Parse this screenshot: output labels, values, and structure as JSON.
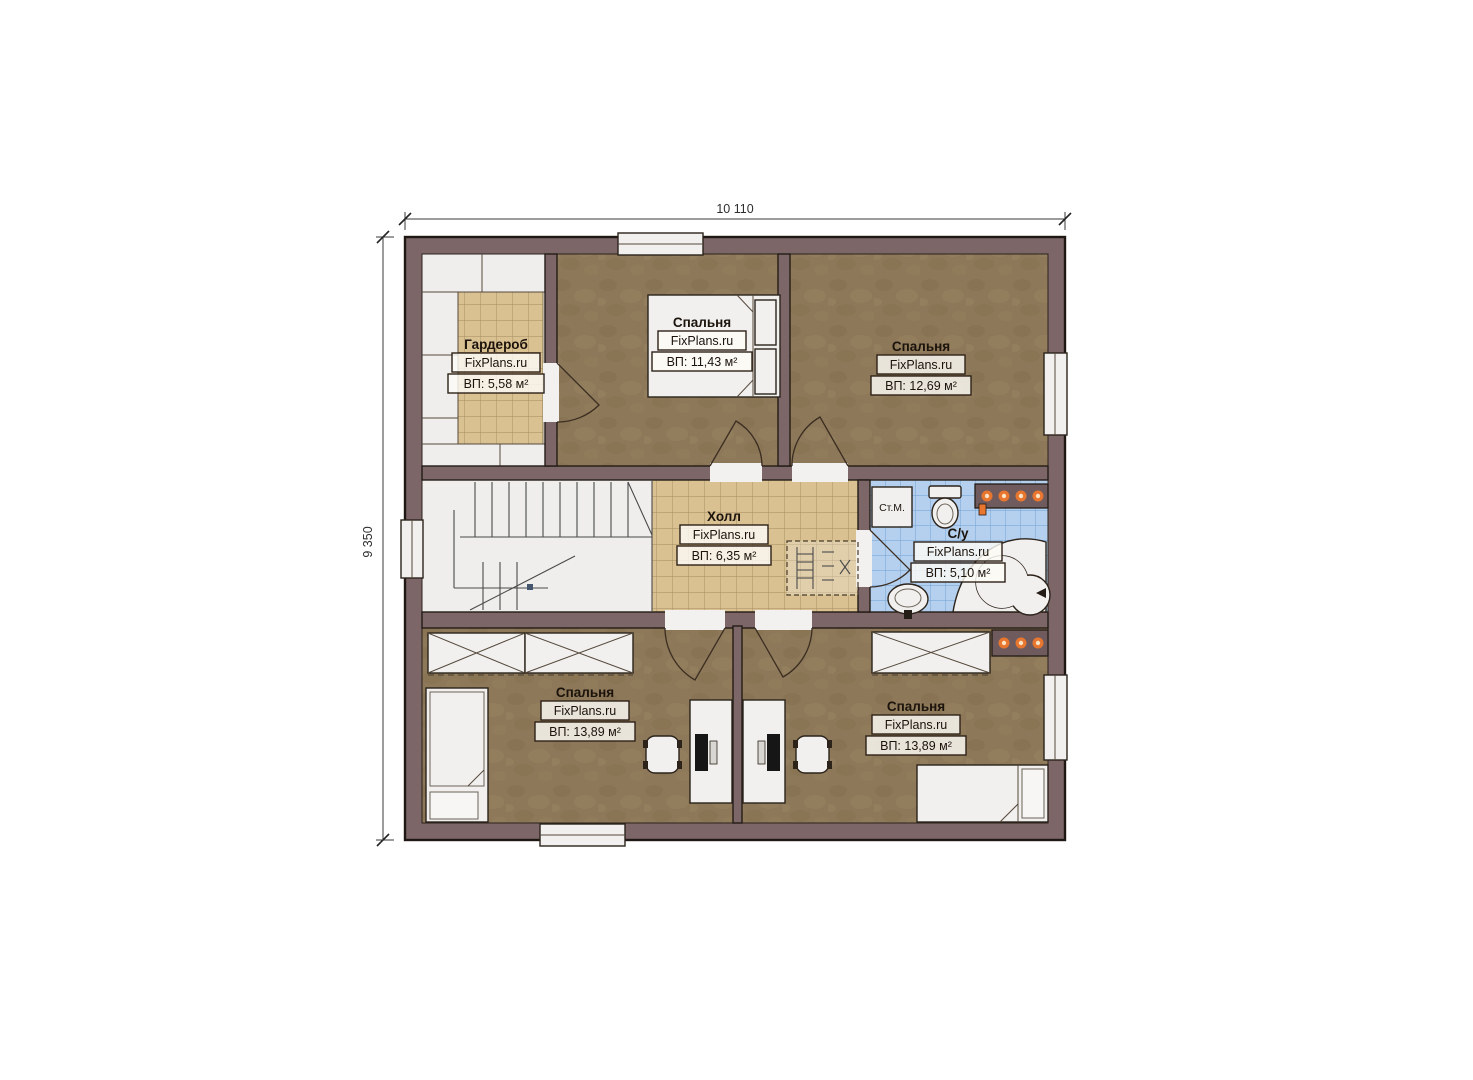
{
  "plan": {
    "title": "floor-plan-second-storey",
    "dimensions": {
      "width_label": "10 110",
      "height_label": "9 350"
    },
    "watermark": "FixPlans.ru",
    "rooms": [
      {
        "name": "Гардероб",
        "watermark": "FixPlans.ru",
        "area": "ВП: 5,58 м²"
      },
      {
        "name": "Спальня",
        "watermark": "FixPlans.ru",
        "area": "ВП: 11,43 м²"
      },
      {
        "name": "Спальня",
        "watermark": "FixPlans.ru",
        "area": "ВП: 12,69 м²"
      },
      {
        "name": "Холл",
        "watermark": "FixPlans.ru",
        "area": "ВП: 6,35 м²"
      },
      {
        "name": "С/у",
        "watermark": "FixPlans.ru",
        "area": "ВП: 5,10 м²"
      },
      {
        "name": "Спальня",
        "watermark": "FixPlans.ru",
        "area": "ВП: 13,89 м²"
      },
      {
        "name": "Спальня",
        "watermark": "FixPlans.ru",
        "area": "ВП: 13,89 м²"
      }
    ],
    "appliances": {
      "washing_machine": "Ст.М."
    },
    "colors": {
      "wall": "#7c6668",
      "floor_wood": "#8d7859",
      "tile_tan": "#d9c192",
      "tile_blue": "#b5d0ee",
      "fixture_white": "#f1f0ee",
      "accent_orange": "#e8762e"
    }
  }
}
